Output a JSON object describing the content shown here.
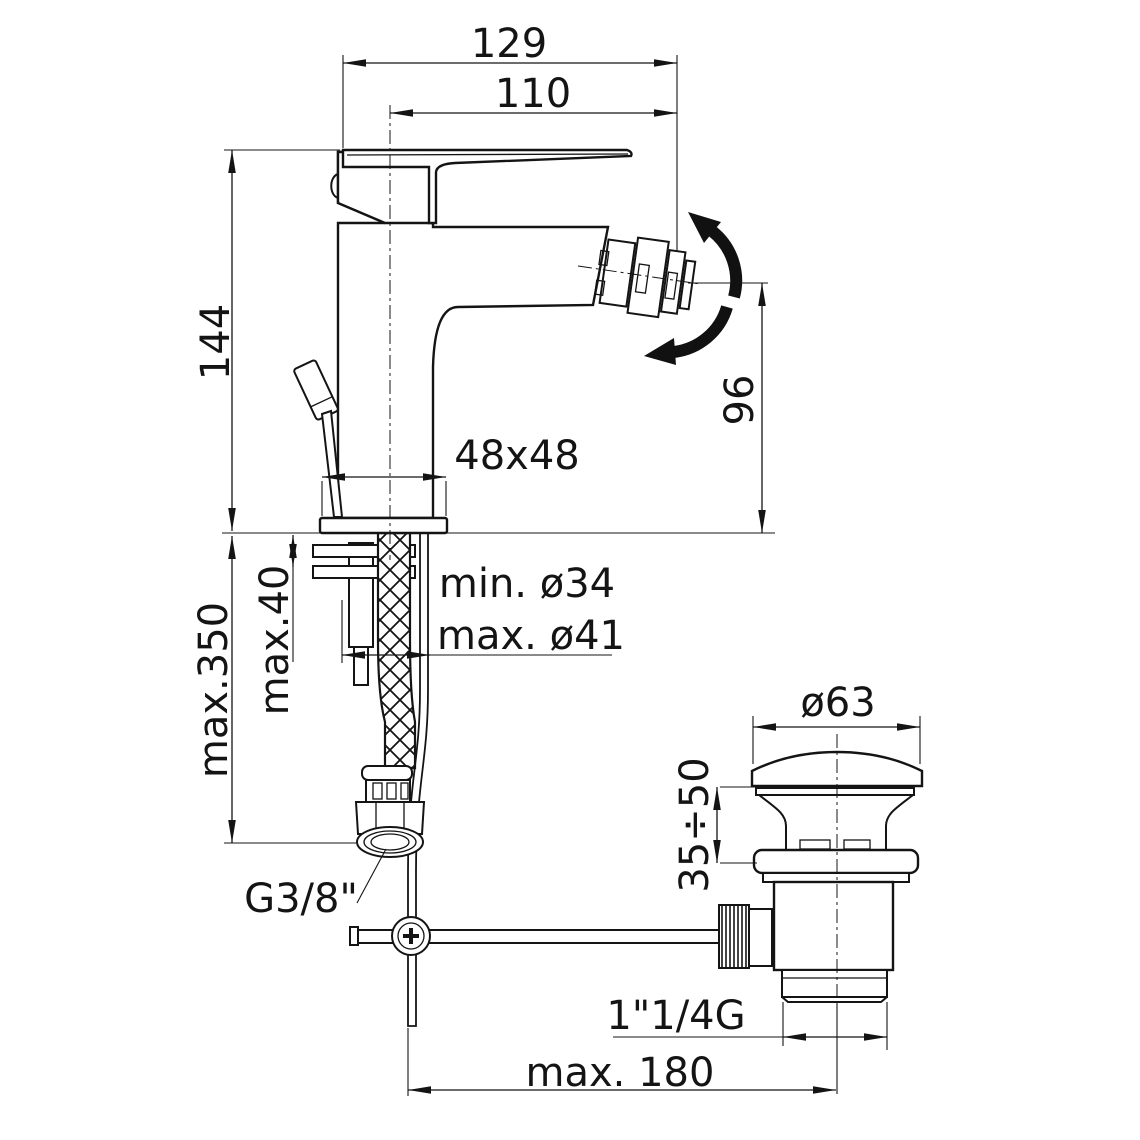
{
  "drawing": {
    "type": "technical-dimension-drawing",
    "subject": "single-lever bidet mixer with flexible supply hose and pop-up waste",
    "line_color": "#141414",
    "background_color": "#ffffff",
    "dimensions": {
      "overall_depth": "129",
      "spout_reach": "110",
      "body_height": "144",
      "spout_height": "96",
      "base_section": "48x48",
      "deck_thickness": "max.40",
      "hose_drop": "max.350",
      "hole_min": "min. ø34",
      "hole_max": "max. ø41",
      "waste_cap_diameter": "ø63",
      "waste_adjust_range": "35÷50",
      "supply_thread": "G3/8\"",
      "waste_thread": "1\"1/4G",
      "rod_offset": "max. 180"
    }
  }
}
